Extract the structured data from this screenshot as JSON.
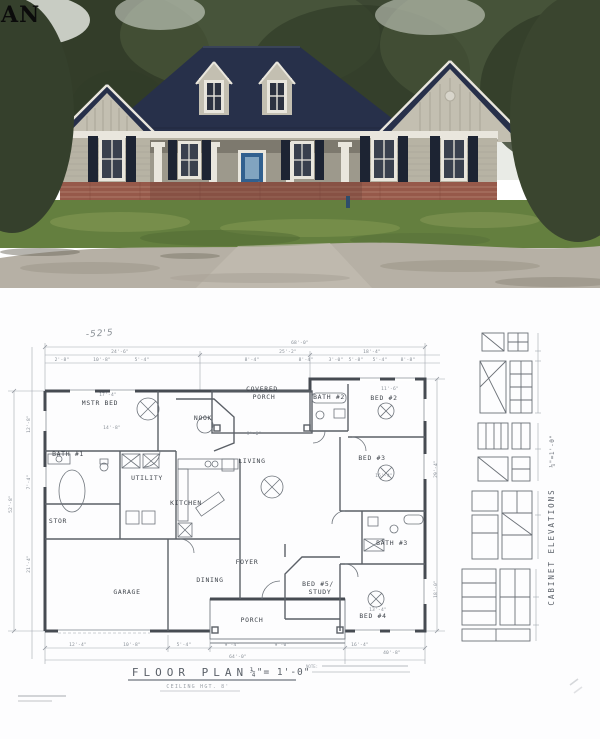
{
  "watermark": "AN",
  "photo": {
    "description": "new-construction ranch house, navy roof, tan siding, brick skirt",
    "colors": {
      "sky": "#e9ebe6",
      "trees": "#3d4833",
      "trees_dark": "#313c28",
      "trees_light": "#556343",
      "roof": "#27304a",
      "siding": "#b7b3a4",
      "gable_siding": "#c3bfb1",
      "porch": "#9d998c",
      "trim": "#e9e6dd",
      "shutters": "#1d2433",
      "door": "#31608f",
      "brick": "#96594a",
      "grass": "#647f3f",
      "dirt": "#b6b0a5"
    }
  },
  "plan": {
    "pencil_note": "-52'5",
    "title": "FLOOR PLAN",
    "title_scale": "¼\"= 1'-0\"",
    "subtitle": "CEILING HGT. 8'",
    "note_label": "NOTE:",
    "cabinet_title": "CABINET ELEVATIONS",
    "cabinet_scale": "¼\"=1'-0\"",
    "rooms": [
      {
        "label": "MSTR BED",
        "x": 100,
        "y": 406
      },
      {
        "label": "BATH #1",
        "x": 68,
        "y": 457
      },
      {
        "label": "STOR",
        "x": 58,
        "y": 524
      },
      {
        "label": "UTILITY",
        "x": 147,
        "y": 481
      },
      {
        "label": "KITCHEN",
        "x": 186,
        "y": 506
      },
      {
        "label": "NOOK",
        "x": 203,
        "y": 421
      },
      {
        "label": "COVERED",
        "x": 262,
        "y": 392
      },
      {
        "label": "PORCH",
        "x": 264,
        "y": 400
      },
      {
        "label": "LIVING",
        "x": 252,
        "y": 464
      },
      {
        "label": "DINING",
        "x": 210,
        "y": 583
      },
      {
        "label": "FOYER",
        "x": 247,
        "y": 565
      },
      {
        "label": "GARAGE",
        "x": 127,
        "y": 595
      },
      {
        "label": "PORCH",
        "x": 252,
        "y": 623
      },
      {
        "label": "BATH #2",
        "x": 329,
        "y": 400
      },
      {
        "label": "BED #2",
        "x": 384,
        "y": 401
      },
      {
        "label": "BED #3",
        "x": 372,
        "y": 461
      },
      {
        "label": "BATH #3",
        "x": 392,
        "y": 546
      },
      {
        "label": "BED #5/",
        "x": 318,
        "y": 587
      },
      {
        "label": "STUDY",
        "x": 320,
        "y": 595
      },
      {
        "label": "BED #4",
        "x": 373,
        "y": 619
      }
    ],
    "dims": [
      {
        "t": "68'-0\"",
        "x": 300,
        "y": 345
      },
      {
        "t": "24'-6\"",
        "x": 120,
        "y": 354
      },
      {
        "t": "25'-2\"",
        "x": 288,
        "y": 354
      },
      {
        "t": "18'-4\"",
        "x": 372,
        "y": 354
      },
      {
        "t": "2'-8\"",
        "x": 62,
        "y": 362
      },
      {
        "t": "10'-8\"",
        "x": 102,
        "y": 362
      },
      {
        "t": "5'-4\"",
        "x": 142,
        "y": 362
      },
      {
        "t": "8'-4\"",
        "x": 252,
        "y": 362
      },
      {
        "t": "8'-4\"",
        "x": 306,
        "y": 362
      },
      {
        "t": "3'-0\"",
        "x": 336,
        "y": 362
      },
      {
        "t": "5'-8\"",
        "x": 356,
        "y": 362
      },
      {
        "t": "5'-4\"",
        "x": 380,
        "y": 362
      },
      {
        "t": "8'-8\"",
        "x": 408,
        "y": 362
      },
      {
        "t": "17'-4\"",
        "x": 108,
        "y": 397
      },
      {
        "t": "14'-8\"",
        "x": 112,
        "y": 430
      },
      {
        "t": "11'-6\"",
        "x": 390,
        "y": 391
      },
      {
        "t": "16'-4\"",
        "x": 384,
        "y": 478
      },
      {
        "t": "9'-6\"",
        "x": 254,
        "y": 436
      },
      {
        "t": "13'-4\"",
        "x": 378,
        "y": 612
      },
      {
        "t": "12'-4\"",
        "x": 78,
        "y": 647
      },
      {
        "t": "10'-8\"",
        "x": 132,
        "y": 647
      },
      {
        "t": "5'-4\"",
        "x": 184,
        "y": 647
      },
      {
        "t": "9'-4\"",
        "x": 232,
        "y": 647
      },
      {
        "t": "9'-0\"",
        "x": 282,
        "y": 647
      },
      {
        "t": "16'-4\"",
        "x": 360,
        "y": 647
      },
      {
        "t": "64'-0\"",
        "x": 238,
        "y": 659
      },
      {
        "t": "40'-8\"",
        "x": 392,
        "y": 655
      },
      {
        "t": "52'-8\"",
        "x": 12,
        "y": 505,
        "r": -90
      },
      {
        "t": "12'-8\"",
        "x": 30,
        "y": 425,
        "r": -90
      },
      {
        "t": "7'-4\"",
        "x": 30,
        "y": 483,
        "r": -90
      },
      {
        "t": "21'-4\"",
        "x": 30,
        "y": 565,
        "r": -90
      },
      {
        "t": "29'-4\"",
        "x": 437,
        "y": 470,
        "r": -90
      },
      {
        "t": "18'-0\"",
        "x": 437,
        "y": 590,
        "r": -90
      }
    ]
  }
}
